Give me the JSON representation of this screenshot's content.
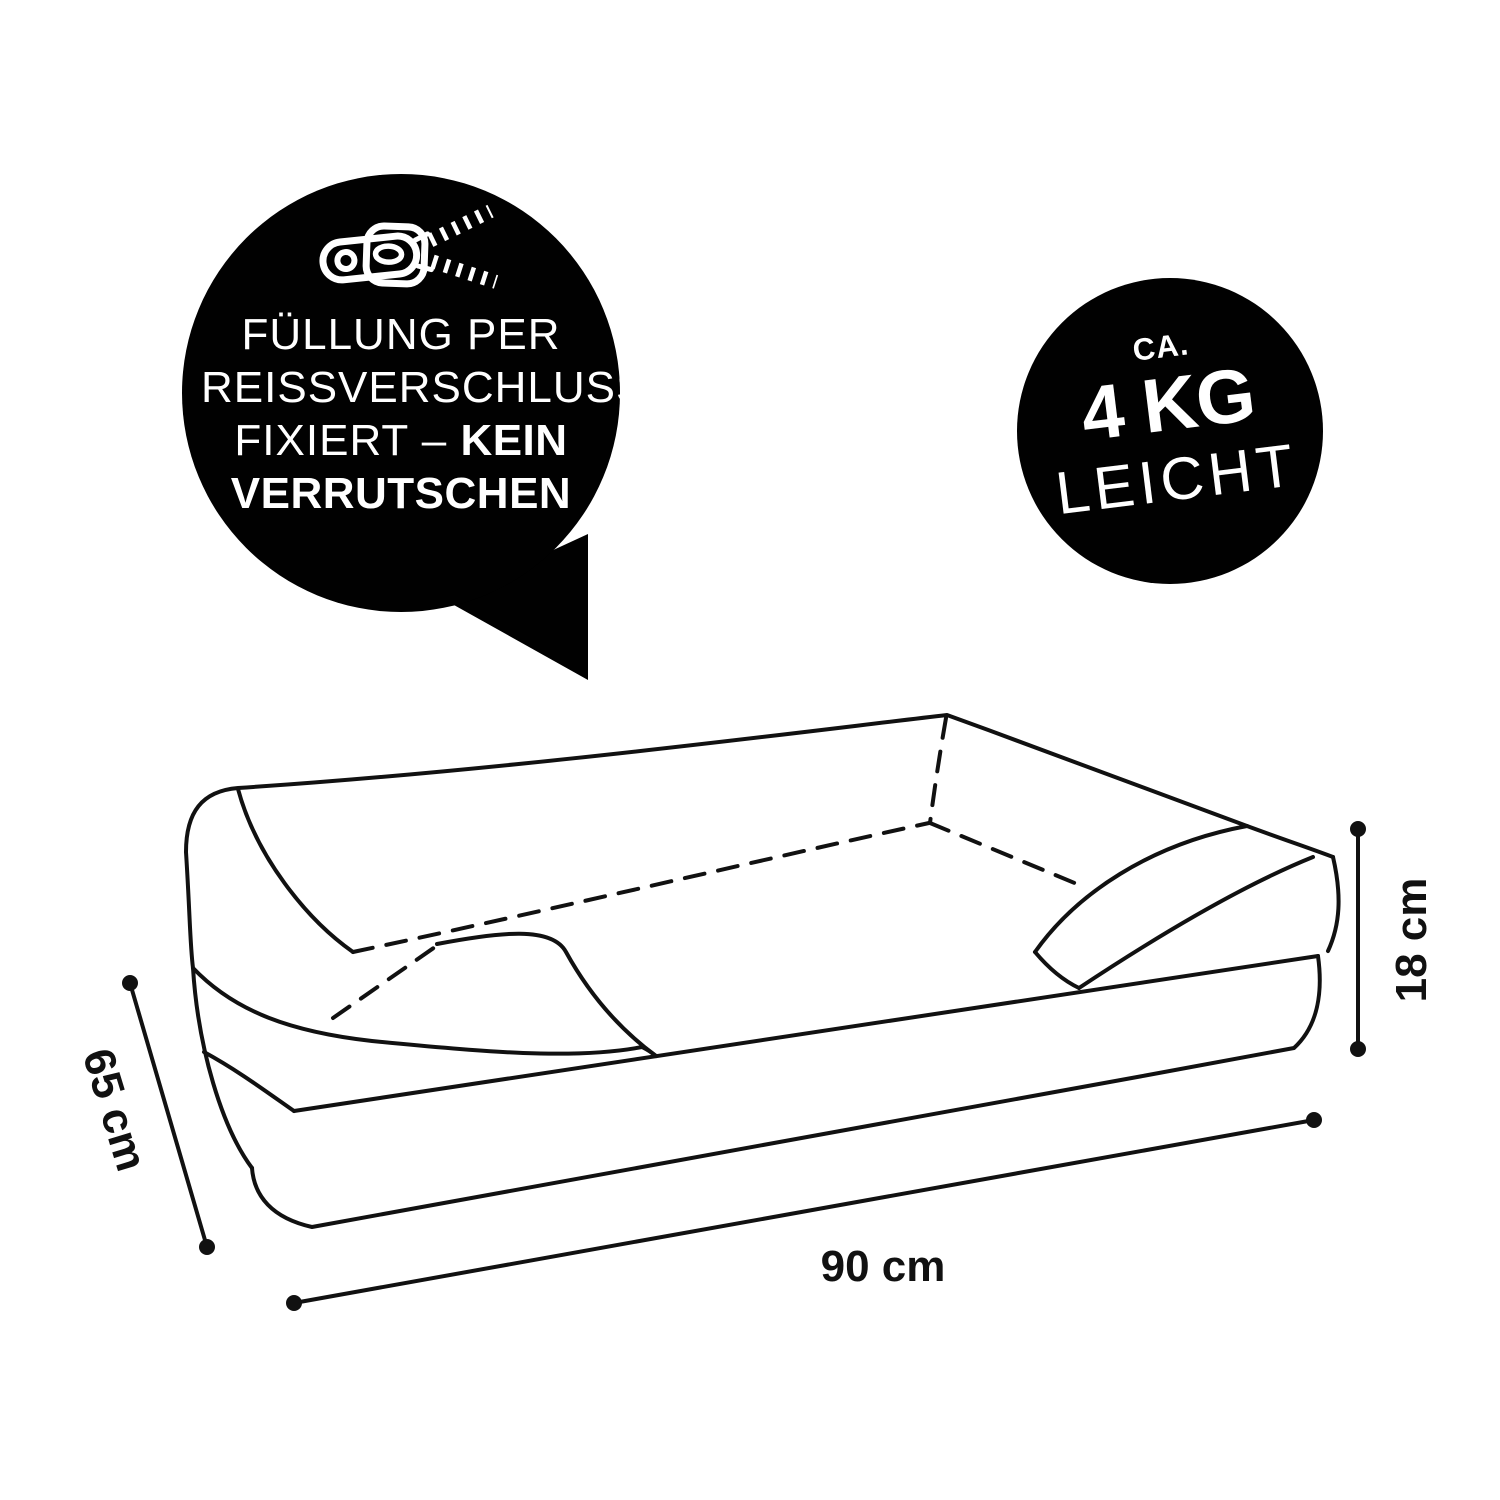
{
  "page": {
    "background": "#ffffff",
    "type": "product-dimension-infographic",
    "subject": "orthopedic pet sofa bed line drawing"
  },
  "badges": {
    "zipper_bubble": {
      "shape": "speech-bubble",
      "bg_color": "#010101",
      "text_color": "#ffffff",
      "icon": "zipper-icon",
      "line1": "FÜLLUNG PER",
      "line2": "REISSVERSCHLUSS",
      "line3_regular": "FIXIERT – ",
      "line3_bold": "KEIN",
      "line4_bold": "VERRUTSCHEN"
    },
    "weight_badge": {
      "shape": "circle",
      "bg_color": "#010101",
      "text_color": "#ffffff",
      "top": "CA.",
      "middle": "4 KG",
      "bottom": "LEICHT"
    }
  },
  "diagram": {
    "line_color": "#111111",
    "dimensions": {
      "width": "90 cm",
      "depth": "65 cm",
      "height": "18 cm"
    }
  }
}
